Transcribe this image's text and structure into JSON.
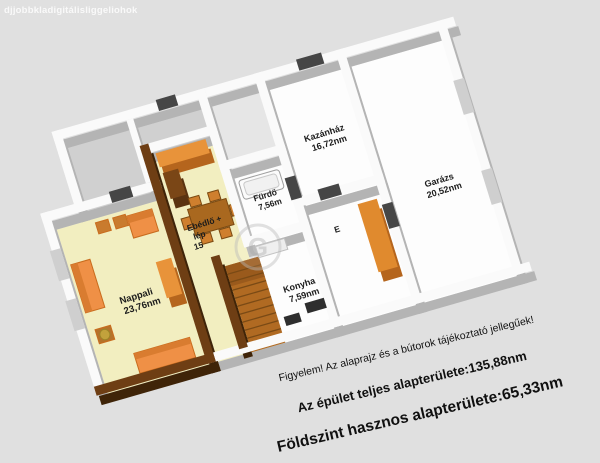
{
  "page": {
    "background": "#e0e0e0"
  },
  "watermarks": {
    "top_left": "djjobbkladigitálisliggeliohok",
    "center_logo_letter": "G"
  },
  "floorplan": {
    "rooms": {
      "nappali": {
        "name": "Nappali",
        "area": "23,76nm"
      },
      "ebedlo": {
        "name": "Ebédlő +",
        "name2": "lép",
        "area": "15"
      },
      "furdo": {
        "name": "Fürdő",
        "area": "7,56m"
      },
      "kazanhaz": {
        "name": "Kazánház",
        "area": "16,72nm"
      },
      "konyha": {
        "name": "Konyha",
        "area": "7,59nm"
      },
      "garazs": {
        "name": "Garázs",
        "area": "20,52nm"
      },
      "eloszoba": {
        "name": "E"
      }
    },
    "colors": {
      "background": "#e0e0e0",
      "floor_yellow": "#f2eec0",
      "floor_white": "#fdfdfd",
      "floor_gray": "#d0d0d0",
      "wall_white": "#fafafa",
      "wall_shadow": "#b4b4b4",
      "wall_brown": "#6e3e14",
      "furniture_orange": "#ef9046",
      "stairs_brown": "#b06a22",
      "door_dark": "#464646"
    }
  },
  "captions": {
    "notice": "Figyelem! Az alaprajz és a bútorok tájékoztató jellegűek!",
    "total_area": "Az épület teljes alapterülete:135,88nm",
    "floor_area": "Földszint hasznos alapterülete:65,33nm"
  }
}
